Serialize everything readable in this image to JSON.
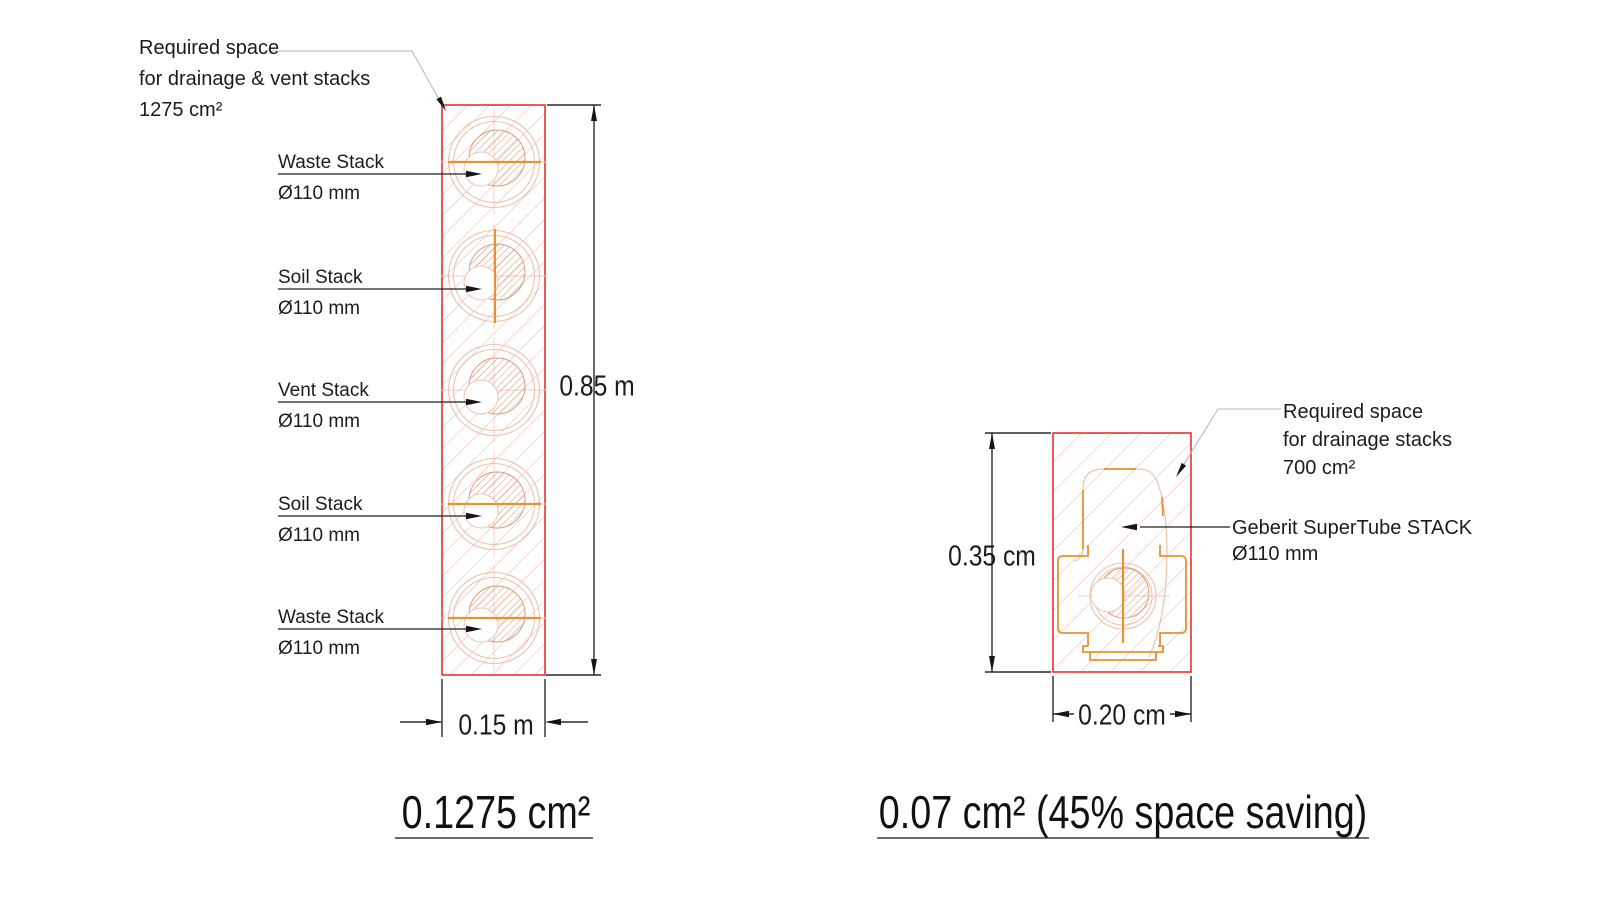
{
  "left": {
    "annotation": [
      "Required space",
      "for drainage & vent stacks",
      "1275 cm²"
    ],
    "stacks": [
      {
        "label": "Waste Stack",
        "size": "Ø110 mm"
      },
      {
        "label": "Soil Stack",
        "size": "Ø110 mm"
      },
      {
        "label": "Vent Stack",
        "size": "Ø110 mm"
      },
      {
        "label": "Soil Stack",
        "size": "Ø110 mm"
      },
      {
        "label": "Waste Stack",
        "size": "Ø110 mm"
      }
    ],
    "height_dim": "0.85 m",
    "width_dim": "0.15 m",
    "caption": "0.1275 cm²"
  },
  "right": {
    "annotation": [
      "Required space",
      "for drainage stacks",
      "700 cm²"
    ],
    "stack_label": [
      "Geberit SuperTube STACK",
      "Ø110 mm"
    ],
    "height_dim": "0.35 cm",
    "width_dim": "0.20 cm",
    "caption": "0.07 cm² (45% space saving)"
  },
  "colors": {
    "wall_outline": "#e8322f",
    "wall_hatch": "#f5adaa",
    "pipe_outline": "#eac3ae",
    "pipe_hatch": "#cf8a5e",
    "water_line_orange": "#e5932f",
    "dimension_line": "#2a2a2a",
    "annotation_leader": "#b6b7bf",
    "text": "#1c1c1c"
  }
}
